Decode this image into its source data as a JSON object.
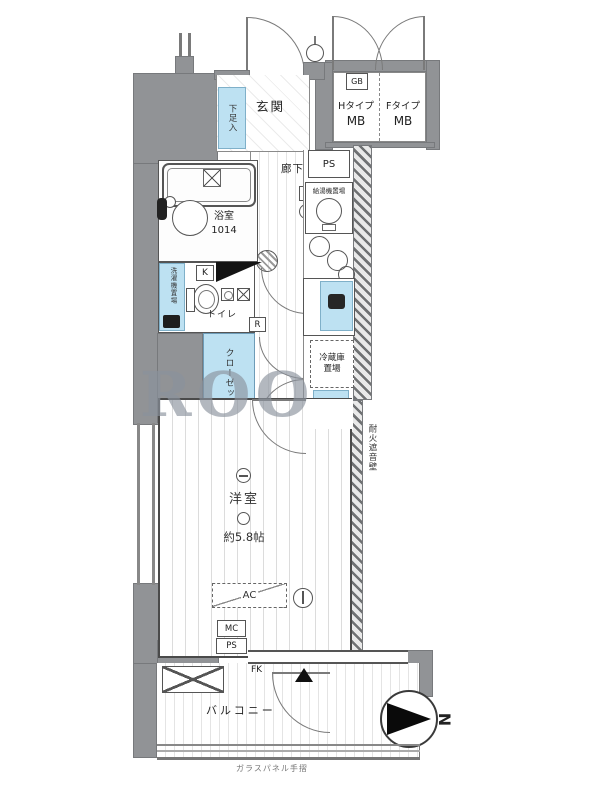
{
  "meta": {
    "type": "floorplan",
    "wall_color": "#919396",
    "highlight_color": "#bde1f2",
    "watermark_color": "#8a929c"
  },
  "watermark": "ROO",
  "labels": {
    "entrance": "玄関",
    "shoe_box": "下足入",
    "hallway": "廊下",
    "bath": "浴室",
    "bath_size": "1014",
    "toilet": "トイレ",
    "laundry": "洗濯機置場",
    "closet": "クローゼット",
    "room": "洋室",
    "room_size": "約5.8帖",
    "balcony": "バルコニー",
    "handrail": "ガラスパネル手摺",
    "firewall": "耐火遮音壁",
    "water_heater": "給湯機置場",
    "fridge_line1": "冷蔵庫",
    "fridge_line2": "置場"
  },
  "boxes": {
    "gb": "GB",
    "ps_top": "PS",
    "c": "C",
    "k": "K",
    "r": "R",
    "ac": "AC",
    "mc": "MC",
    "ps_bottom": "PS",
    "fk": "FK"
  },
  "mb": {
    "left_type": "Hタイプ",
    "right_type": "Fタイプ",
    "label": "MB"
  },
  "compass": {
    "n": "N"
  }
}
